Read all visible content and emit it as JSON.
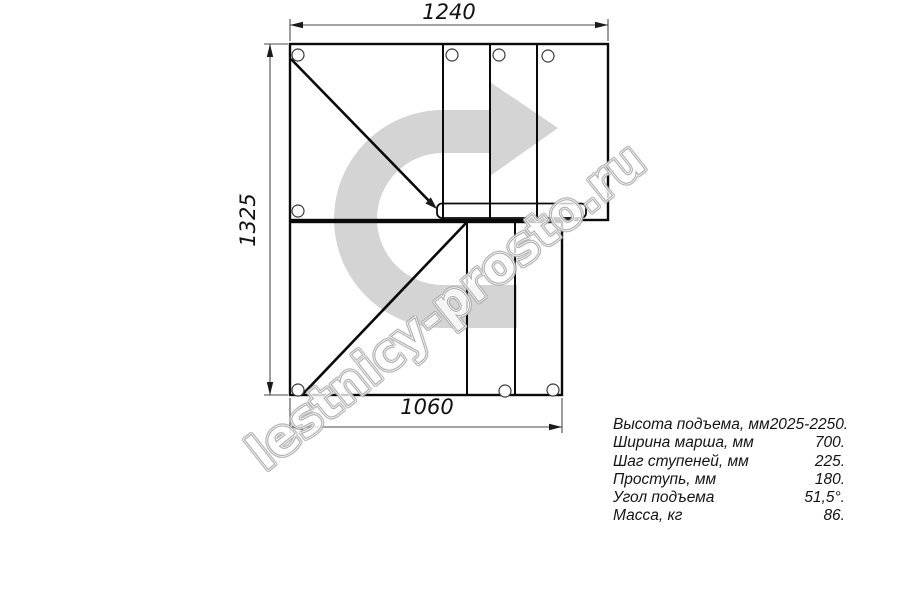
{
  "drawing": {
    "dim_top": "1240",
    "dim_left": "1325",
    "dim_bottom": "1060"
  },
  "watermark": {
    "text": "lestnicy-prosto.ru",
    "outline_color": "#a6a6a6",
    "arrow_color": "#d4d4d4"
  },
  "specs": {
    "rows": [
      {
        "label": "Высота подъема, мм",
        "value": "2025-2250."
      },
      {
        "label": "Ширина марша, мм",
        "value": "700."
      },
      {
        "label": "Шаг ступеней, мм",
        "value": "225."
      },
      {
        "label": "Проступь, мм",
        "value": "180."
      },
      {
        "label": "Угол подъема",
        "value": "51,5°."
      },
      {
        "label": "Масса, кг",
        "value": "86."
      }
    ]
  }
}
